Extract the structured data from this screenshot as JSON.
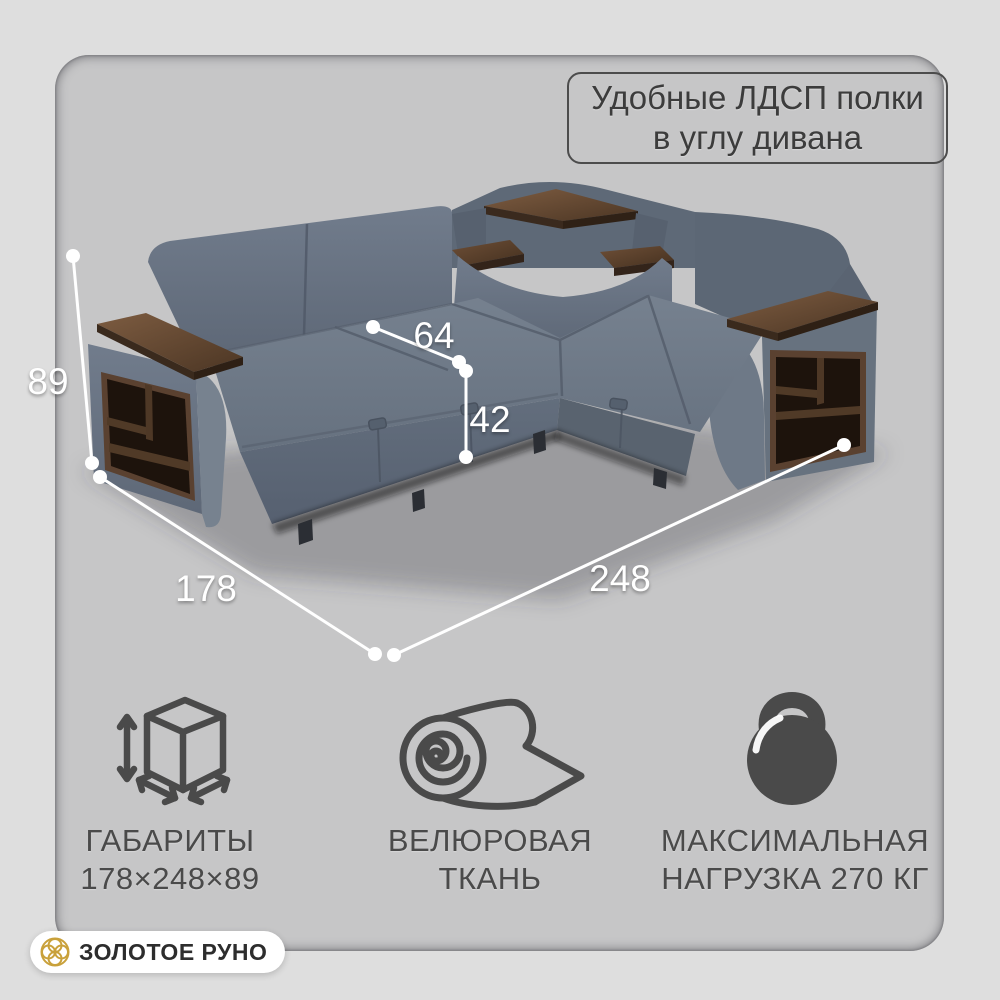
{
  "callout": {
    "line1": "Удобные ЛДСП полки",
    "line2": "в углу дивана"
  },
  "dimensions": {
    "height": "89",
    "side_depth": "178",
    "width": "248",
    "seat_depth": "64",
    "seat_height": "42"
  },
  "features": [
    {
      "icon": "cube-dimensions-icon",
      "line1": "ГАБАРИТЫ",
      "line2": "178×248×89"
    },
    {
      "icon": "fabric-roll-icon",
      "line1": "ВЕЛЮРОВАЯ",
      "line2": "ТКАНЬ"
    },
    {
      "icon": "kettlebell-icon",
      "line1": "МАКСИМАЛЬНАЯ",
      "line2": "НАГРУЗКА 270 КГ"
    }
  ],
  "brand": {
    "name": "ЗОЛОТОЕ РУНО"
  },
  "colors": {
    "background": "#dedede",
    "panel": "#c6c6c7",
    "fabric": "#6b7685",
    "wood": "#5a4130",
    "shelf_interior": "#1d130c",
    "dimension_lines": "#ffffff",
    "text_dark": "#3c3c3c",
    "icon_gray": "#4a4a4a",
    "brand_gold": "#c9a13b"
  }
}
